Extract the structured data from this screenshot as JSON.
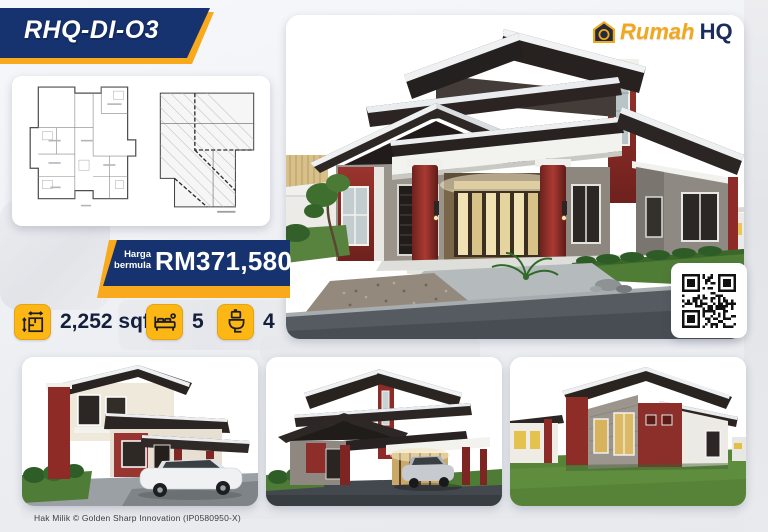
{
  "badge": {
    "code": "RHQ-DI-O3"
  },
  "logo": {
    "brand_primary": "Rumah",
    "brand_secondary": "HQ"
  },
  "price": {
    "label_line1": "Harga",
    "label_line2": "bermula",
    "amount": "RM371,580"
  },
  "specs": {
    "area": {
      "value": "2,252 sqf"
    },
    "bedrooms": {
      "value": "5"
    },
    "bathrooms": {
      "value": "4"
    }
  },
  "footer": {
    "copyright": "Hak Milik © Golden Sharp Innovation (IP0580950-X)"
  },
  "icons": {
    "logo-house-icon": "house-outline-monogram",
    "area-icon": "floorplan-with-dimension-arrows",
    "bed-icon": "double-bed",
    "toilet-icon": "toilet",
    "qr-code": "qr-pattern"
  },
  "images": {
    "main_render": "house-exterior-front-perspective",
    "thumb_left": "house-exterior-two-storey-with-sports-car",
    "thumb_middle": "house-exterior-front-with-car",
    "thumb_right": "house-exterior-side-view-lawn",
    "floor_plan_left": "floor-plan",
    "floor_plan_right": "roof-plan"
  },
  "colors": {
    "navy": "#16336F",
    "gold": "#FDB714",
    "gold_dark": "#F9A91C",
    "maroon": "#8C2B27",
    "text_dark": "#141F3C"
  }
}
